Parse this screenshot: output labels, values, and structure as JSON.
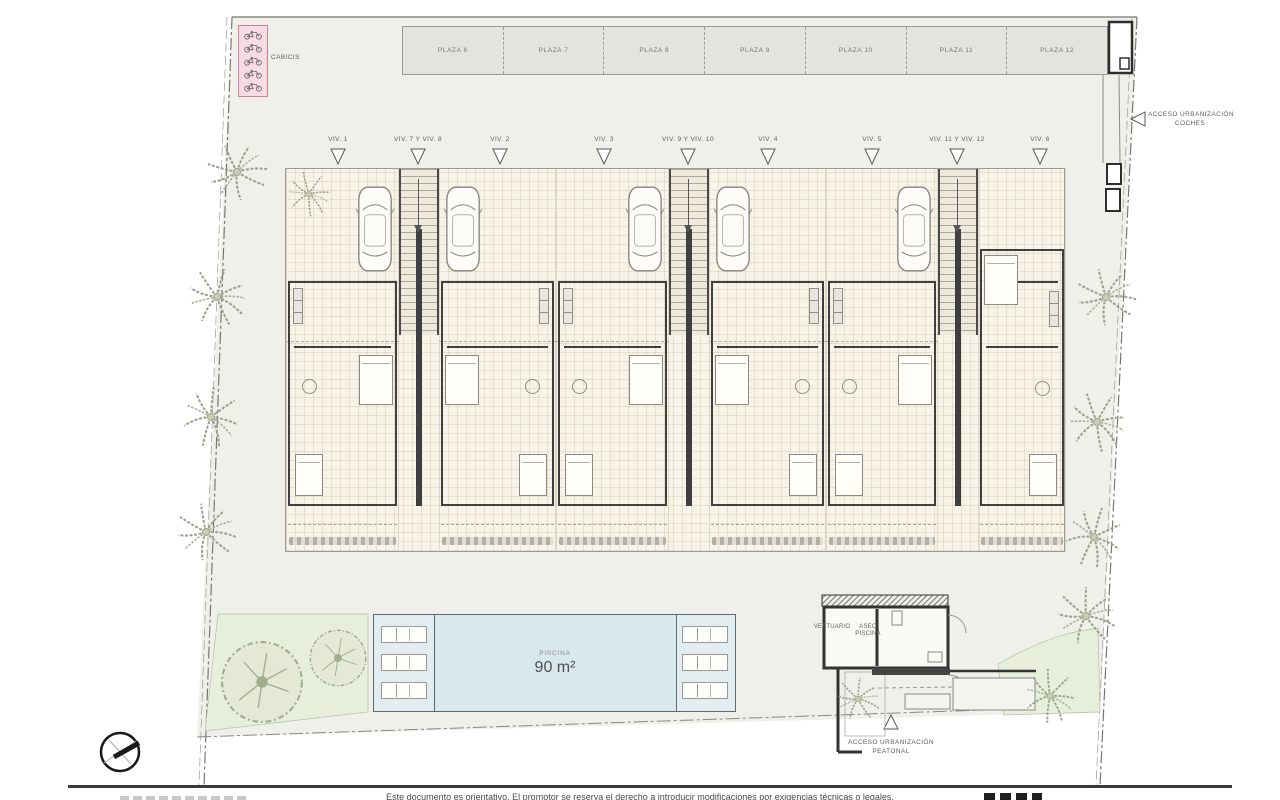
{
  "parking": {
    "plazas": [
      {
        "label": "PLAZA 6"
      },
      {
        "label": "PLAZA 7"
      },
      {
        "label": "PLAZA 8"
      },
      {
        "label": "PLAZA 9"
      },
      {
        "label": "PLAZA 10"
      },
      {
        "label": "PLAZA 11"
      },
      {
        "label": "PLAZA 12"
      }
    ]
  },
  "bike_storage": {
    "label": "CABICIS"
  },
  "units": {
    "labels": [
      "VIV. 1",
      "VIV. 7 Y VIV. 8",
      "VIV. 2",
      "VIV. 3",
      "VIV. 9 Y VIV. 10",
      "VIV. 4",
      "VIV. 5",
      "VIV. 11 Y VIV. 12",
      "VIV. 6"
    ]
  },
  "access": {
    "cars": {
      "line1": "ACCESO URBANIZACIÓN",
      "line2": "COCHES"
    },
    "pedestrian": {
      "line1": "ACCESO URBANIZACIÓN",
      "line2": "PEATONAL"
    }
  },
  "pool": {
    "label": "PISCINA",
    "area": "90 m²"
  },
  "pool_house": {
    "changing_room": "VESTUARIO",
    "toilet_line1": "ASEO",
    "toilet_line2": "PISCINA"
  },
  "footer": {
    "disclaimer": "Este documento es orientativo. El promotor se reserva el derecho a introducir modificaciones por exigencias técnicas o legales."
  },
  "colors": {
    "site": "#eff0ea",
    "building_floor": "#f8f3e8",
    "walls": "#3f3f3f",
    "pool": "#d8e8ee",
    "garden": "#e7eeda",
    "bike_box": "#f9dbe6",
    "plaza": "#e2e4df"
  }
}
